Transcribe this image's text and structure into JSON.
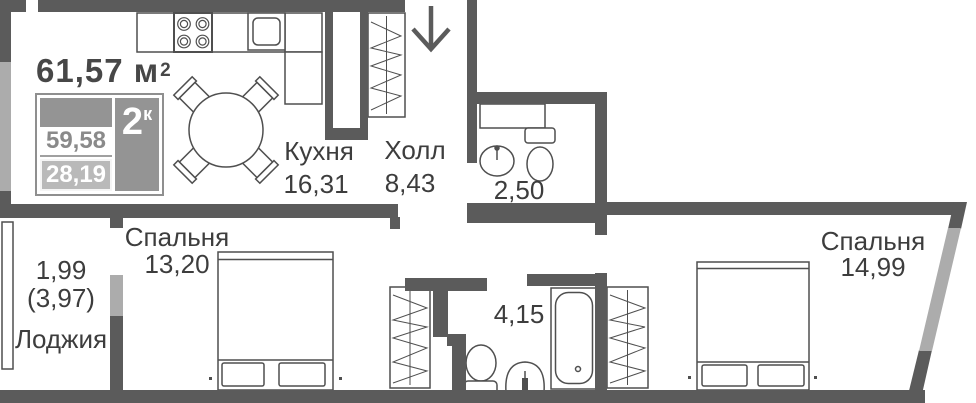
{
  "header": {
    "total_area": "61,57 м",
    "total_area_sup": "2"
  },
  "badge": {
    "rooms_count": "2",
    "rooms_sup": "к",
    "area_row1": "59,58",
    "area_row2": "28,19"
  },
  "rooms": {
    "kitchen": {
      "name": "Кухня",
      "area": "16,31"
    },
    "hall": {
      "name": "Холл",
      "area": "8,43"
    },
    "bathroom_small": {
      "area": "2,50"
    },
    "bedroom_left": {
      "name": "Спальня",
      "area": "13,20"
    },
    "bathroom_large": {
      "area": "4,15"
    },
    "bedroom_right": {
      "name": "Спальня",
      "area": "14,99"
    },
    "loggia": {
      "name": "Лоджия",
      "area": "1,99",
      "area_full": "(3,97)"
    }
  },
  "colors": {
    "wall": "#5b5b5b",
    "window": "#acacac",
    "outline": "#4f4f4f",
    "text": "#3d3d3d",
    "badge_gray": "#949494",
    "badge_light_band": "#b9b9b9"
  }
}
